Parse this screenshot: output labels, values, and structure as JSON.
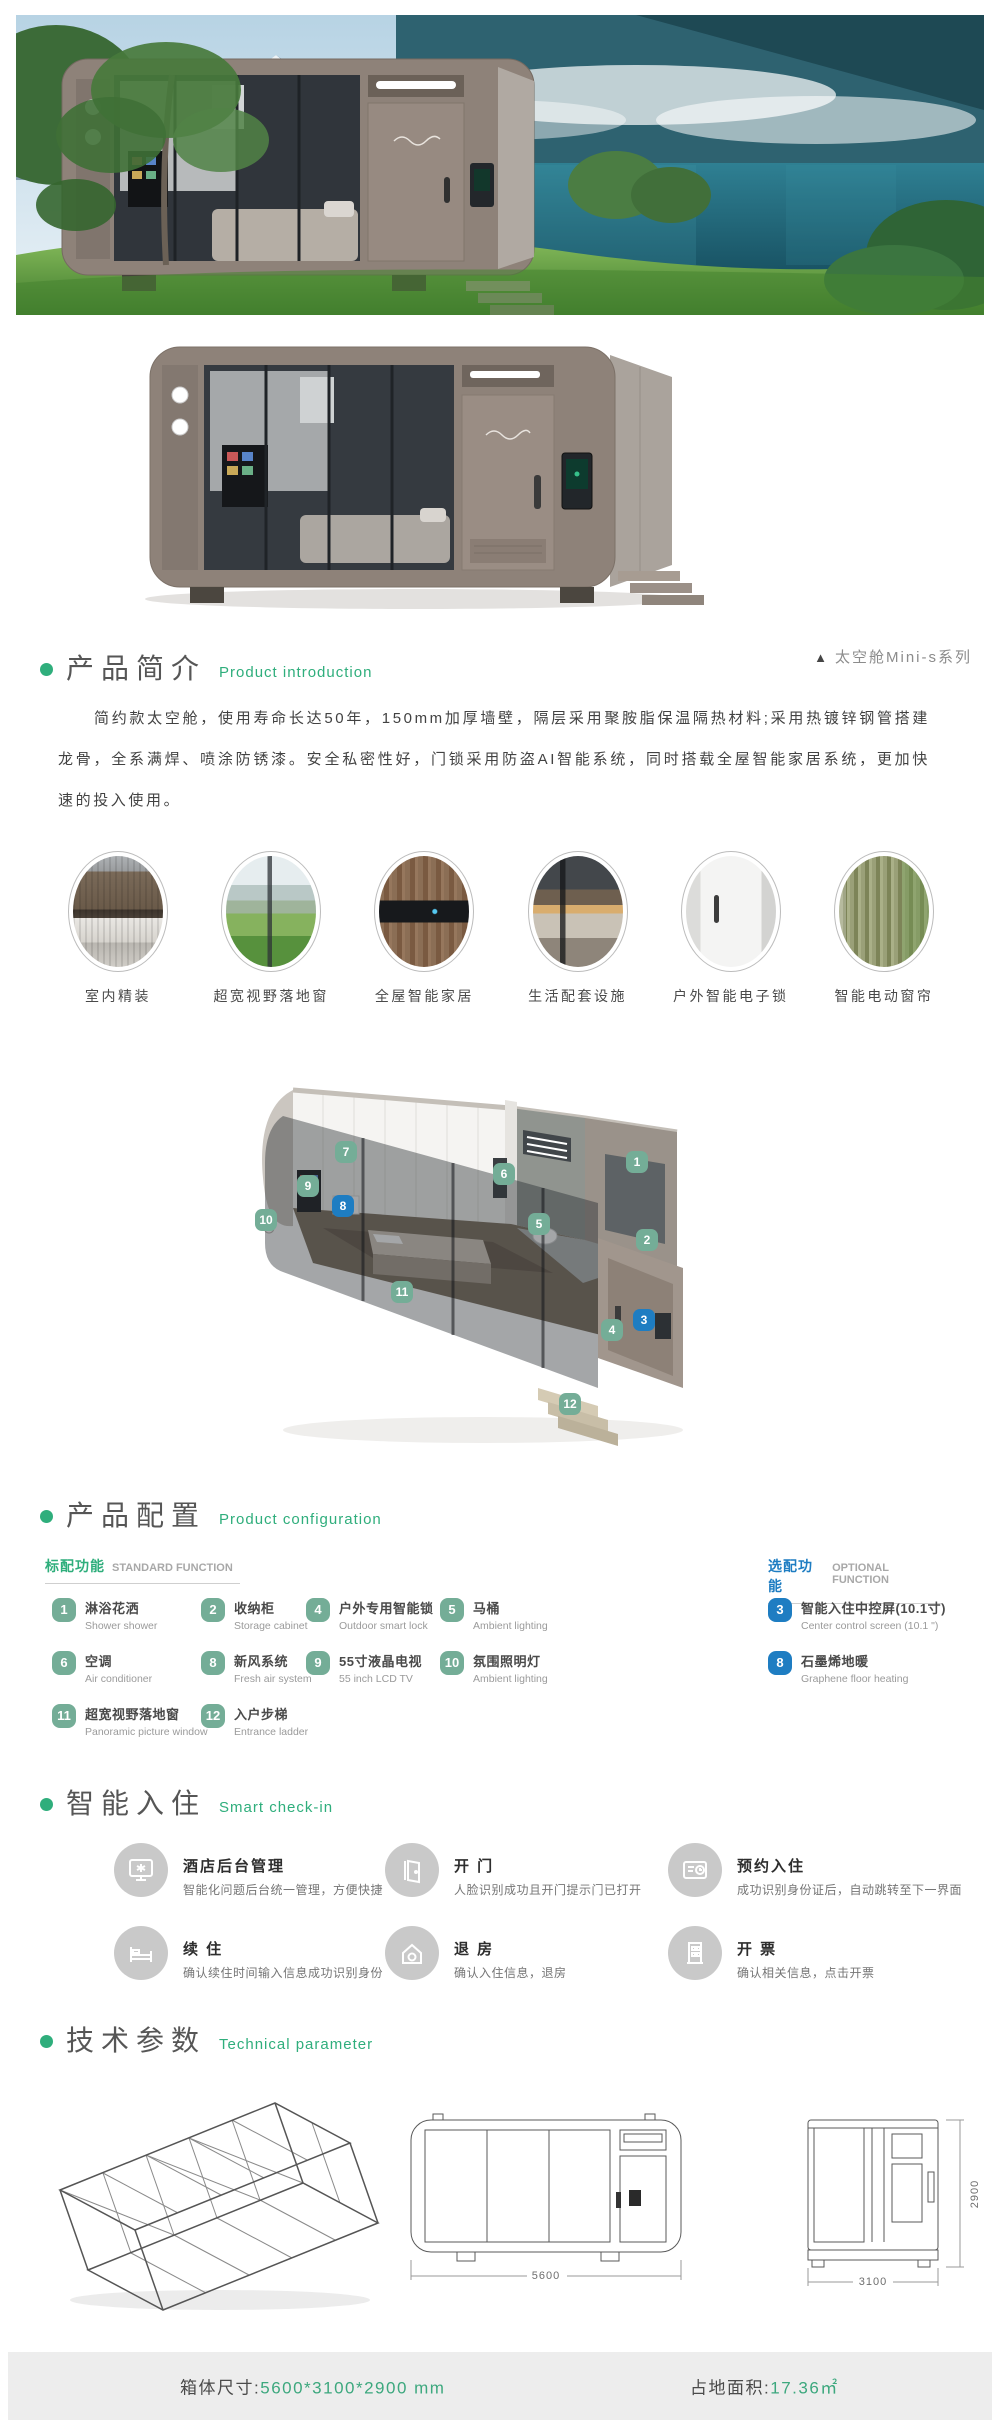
{
  "colors": {
    "accent_green": "#2fae7c",
    "accent_blue": "#1e7dc2",
    "badge_green": "#74ad97",
    "badge_blue": "#1e7dc2",
    "footer_bg": "#ededed",
    "footer_value_green": "#3da87e"
  },
  "intro": {
    "title_zh": "产品简介",
    "title_en": "Product introduction",
    "series_marker": "▲",
    "series_tag": "太空舱Mini-s系列",
    "paragraph": "简约款太空舱，使用寿命长达50年，150mm加厚墙壁，隔层采用聚胺脂保温隔热材料;采用热镀锌钢管搭建龙骨，全系满焊、喷涂防锈漆。安全私密性好，门锁采用防盗AI智能系统，同时搭载全屋智能家居系统，更加快速的投入使用。"
  },
  "features": {
    "items": [
      {
        "label": "室内精装"
      },
      {
        "label": "超宽视野落地窗"
      },
      {
        "label": "全屋智能家居"
      },
      {
        "label": "生活配套设施"
      },
      {
        "label": "户外智能电子锁"
      },
      {
        "label": "智能电动窗帘"
      }
    ]
  },
  "cutaway": {
    "badges": [
      {
        "n": "1",
        "color": "green"
      },
      {
        "n": "2",
        "color": "green"
      },
      {
        "n": "3",
        "color": "blue"
      },
      {
        "n": "4",
        "color": "green"
      },
      {
        "n": "5",
        "color": "green"
      },
      {
        "n": "6",
        "color": "green"
      },
      {
        "n": "7",
        "color": "green"
      },
      {
        "n": "8",
        "color": "blue"
      },
      {
        "n": "9",
        "color": "green"
      },
      {
        "n": "10",
        "color": "green"
      },
      {
        "n": "11",
        "color": "green"
      },
      {
        "n": "12",
        "color": "green"
      }
    ]
  },
  "config": {
    "title_zh": "产品配置",
    "title_en": "Product configuration",
    "standard_header_zh": "标配功能",
    "standard_header_en": "STANDARD FUNCTION",
    "optional_header_zh": "选配功能",
    "optional_header_en": "OPTIONAL FUNCTION",
    "standard": [
      {
        "num": "1",
        "zh": "淋浴花洒",
        "en": "Shower shower"
      },
      {
        "num": "2",
        "zh": "收纳柜",
        "en": "Storage cabinet"
      },
      {
        "num": "4",
        "zh": "户外专用智能锁",
        "en": "Outdoor smart lock"
      },
      {
        "num": "5",
        "zh": "马桶",
        "en": "Ambient lighting"
      },
      {
        "num": "6",
        "zh": "空调",
        "en": "Air conditioner"
      },
      {
        "num": "8",
        "zh": "新风系统",
        "en": "Fresh air system"
      },
      {
        "num": "9",
        "zh": "55寸液晶电视",
        "en": "55 inch LCD TV"
      },
      {
        "num": "10",
        "zh": "氛围照明灯",
        "en": "Ambient lighting"
      },
      {
        "num": "11",
        "zh": "超宽视野落地窗",
        "en": "Panoramic picture window"
      },
      {
        "num": "12",
        "zh": "入户步梯",
        "en": "Entrance ladder"
      }
    ],
    "optional": [
      {
        "num": "3",
        "zh": "智能入住中控屏(10.1寸)",
        "en": "Center control screen (10.1 \")"
      },
      {
        "num": "8",
        "zh": "石墨烯地暖",
        "en": "Graphene floor heating"
      }
    ]
  },
  "checkin": {
    "title_zh": "智能入住",
    "title_en": "Smart check-in",
    "items": [
      {
        "title": "酒店后台管理",
        "desc": "智能化问题后台统一管理，方便快捷",
        "icon": "console-icon"
      },
      {
        "title": "开 门",
        "desc": "人脸识别成功且开门提示门已打开",
        "icon": "door-icon"
      },
      {
        "title": "预约入住",
        "desc": "成功识别身份证后，自动跳转至下一界面",
        "icon": "reservation-icon"
      },
      {
        "title": "续 住",
        "desc": "确认续住时间输入信息成功识别身份",
        "icon": "bed-icon"
      },
      {
        "title": "退 房",
        "desc": "确认入住信息，退房",
        "icon": "checkout-icon"
      },
      {
        "title": "开 票",
        "desc": "确认相关信息，点击开票",
        "icon": "invoice-icon"
      }
    ]
  },
  "tech": {
    "title_zh": "技术参数",
    "title_en": "Technical parameter",
    "front_width": "5600",
    "side_width": "3100",
    "height": "2900"
  },
  "footer": {
    "size_label": "箱体尺寸:",
    "size_value": "5600*3100*2900 mm",
    "area_label": "占地面积:",
    "area_value": "17.36㎡"
  }
}
